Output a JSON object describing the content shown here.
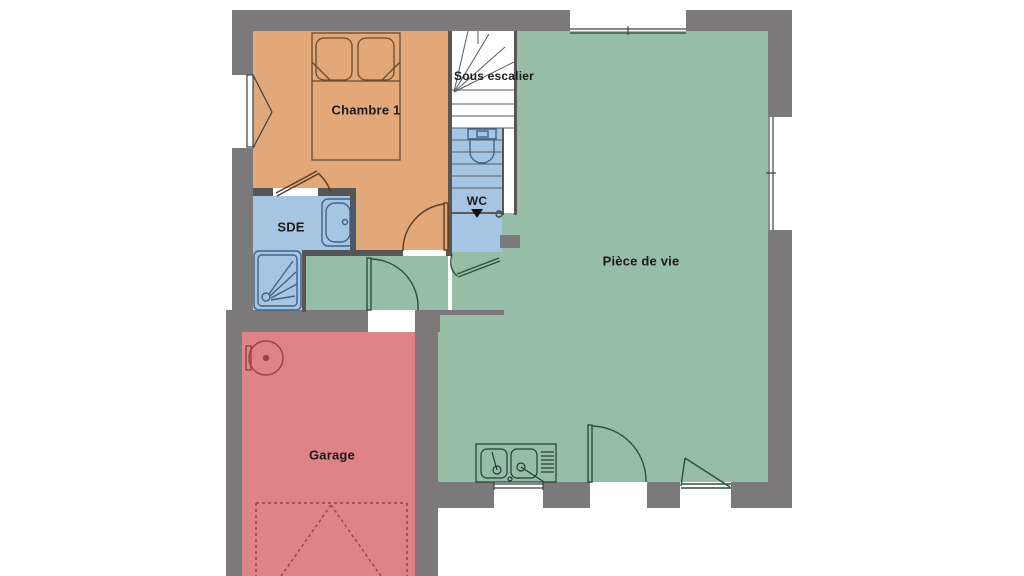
{
  "floorplan": {
    "rooms": {
      "chambre1": {
        "label": "Chambre 1"
      },
      "sous_escalier": {
        "label": "Sous escalier"
      },
      "wc": {
        "label": "WC"
      },
      "sde": {
        "label": "SDE"
      },
      "piece_de_vie": {
        "label": "Pièce de vie"
      },
      "garage": {
        "label": "Garage"
      }
    },
    "colors": {
      "background": "#ffffff",
      "wall": "#7b797a",
      "partition": "#565656",
      "bedroom": "#e2a87a",
      "sanitary": "#a6c5e2",
      "living": "#96bda6",
      "garage": "#df8486",
      "stair": "#ffffff"
    },
    "fixtures": [
      "double-bed",
      "bathtub",
      "shower-tray",
      "toilet",
      "staircase",
      "kitchen-sink",
      "water-heater",
      "garage-door"
    ]
  }
}
